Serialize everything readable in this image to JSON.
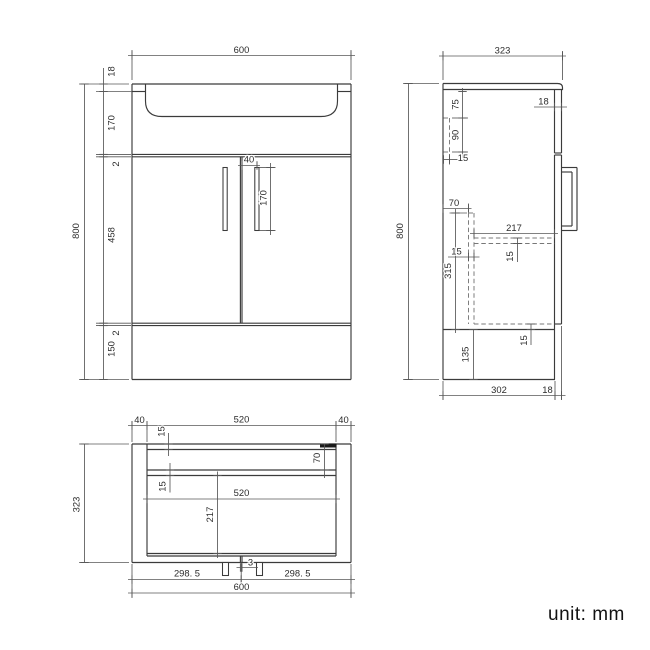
{
  "unit_note": "unit: mm",
  "colors": {
    "line": "#3b3b3b",
    "thin": "#575757",
    "dash": "#787878",
    "text": "#2b2b2b",
    "mark": "#1a1a1a"
  },
  "views": [
    {
      "name": "front-view",
      "lines": [
        [
          132,
          84,
          351,
          84
        ],
        [
          132,
          84,
          132,
          379.5
        ],
        [
          351,
          84,
          351,
          379.5
        ],
        [
          132,
          379.5,
          351,
          379.5
        ],
        [
          132,
          91.5,
          145.5,
          91.5
        ],
        [
          337.5,
          91.5,
          351,
          91.5
        ],
        [
          132,
          154.4,
          351,
          154.4
        ],
        [
          132,
          156.8,
          351,
          156.8
        ],
        [
          132,
          323.2,
          351,
          323.2
        ],
        [
          132,
          325.6,
          351,
          325.6
        ],
        [
          240.4,
          156.8,
          240.4,
          323.2
        ],
        [
          242,
          156.8,
          242,
          323.2
        ],
        [
          554.5,
          0,
          554.5,
          0
        ]
      ],
      "paths": [
        "M145.5,84 L145.5,101 Q145.5,116.5 162,116.5 L321,116.5 Q337.5,116.5 337.5,101 L337.5,84"
      ],
      "thin": [
        [
          132,
          80,
          132,
          50
        ],
        [
          351,
          80,
          351,
          50
        ],
        [
          129,
          84,
          79,
          84
        ],
        [
          129,
          379.5,
          79,
          379.5
        ],
        [
          96,
          91.5,
          132,
          91.5
        ],
        [
          96,
          154.4,
          131,
          154.4
        ],
        [
          96,
          156.8,
          131,
          156.8
        ],
        [
          96,
          323.2,
          131,
          323.2
        ],
        [
          96,
          325.6,
          131,
          325.6
        ],
        [
          257,
          170,
          257,
          161.5
        ],
        [
          259.5,
          167.5,
          275.5,
          167.5
        ],
        [
          259.5,
          230.5,
          275.5,
          230.5
        ]
      ],
      "dashed": [],
      "outline_rects": [
        [
          223,
          167.5,
          4.2,
          63
        ],
        [
          254.8,
          167.5,
          4.2,
          63
        ]
      ],
      "filled_rects": [],
      "dims": [
        {
          "o": "h",
          "p": 55.5,
          "a": 128,
          "b": 355,
          "t": [
            132,
            351
          ],
          "l": [
            {
              "s": "600",
              "x": 241.5,
              "y": 50.5,
              "r": 0
            }
          ]
        },
        {
          "o": "v",
          "p": 84.5,
          "a": 84,
          "b": 379.5,
          "t": [
            84,
            379.5
          ],
          "l": [
            {
              "s": "800",
              "x": 76.5,
              "y": 231,
              "r": -90
            }
          ]
        },
        {
          "o": "v",
          "p": 103.5,
          "a": 68,
          "b": 379.5,
          "t": [
            84,
            91.5,
            154.4,
            156.8,
            323.2,
            325.6,
            379.5
          ],
          "l": [
            {
              "s": "18",
              "x": 112,
              "y": 71.5,
              "r": -90
            },
            {
              "s": "170",
              "x": 112,
              "y": 123,
              "r": -90
            },
            {
              "s": "2",
              "x": 116.5,
              "y": 164,
              "r": -90
            },
            {
              "s": "458",
              "x": 112,
              "y": 235,
              "r": -90
            },
            {
              "s": "2",
              "x": 116.5,
              "y": 333,
              "r": -90
            },
            {
              "s": "150",
              "x": 112,
              "y": 349,
              "r": -90
            }
          ]
        },
        {
          "o": "h",
          "p": 165.5,
          "a": 238,
          "b": 260,
          "t": [
            242,
            257
          ],
          "l": [
            {
              "s": "40",
              "x": 249,
              "y": 160,
              "r": 0
            }
          ]
        },
        {
          "o": "v",
          "p": 270.5,
          "a": 163,
          "b": 235,
          "t": [
            167.5,
            230.5
          ],
          "l": [
            {
              "s": "170",
              "x": 264,
              "y": 198,
              "r": -90
            }
          ]
        }
      ]
    },
    {
      "name": "side-view",
      "lines": [
        [
          443,
          83.5,
          443,
          379.5
        ],
        [
          443,
          379.5,
          555,
          379.5
        ],
        [
          554.5,
          89.5,
          554.5,
          153
        ],
        [
          554.5,
          155,
          554.5,
          379.5
        ],
        [
          561.5,
          89.5,
          561.5,
          153
        ],
        [
          561.5,
          155,
          561.5,
          324
        ],
        [
          554.5,
          153,
          561.5,
          153
        ],
        [
          554.5,
          155,
          561.5,
          155
        ],
        [
          554.5,
          324,
          561.5,
          324
        ],
        [
          443,
          329.5,
          554.5,
          329.5
        ],
        [
          561.5,
          167.5,
          577,
          167.5
        ],
        [
          577,
          167.5,
          577,
          230.5
        ],
        [
          561.5,
          230.5,
          577,
          230.5
        ],
        [
          561.5,
          172,
          572,
          172
        ],
        [
          572,
          172,
          572,
          226
        ],
        [
          561.5,
          226,
          572,
          226
        ]
      ],
      "paths": [
        "M443,83.5 L557.5,83.5 Q562.5,83.5 562.5,87.5 L562.5,89.5 L443,89.5"
      ],
      "thin": [
        [
          443,
          80,
          443,
          51
        ],
        [
          562.5,
          80,
          562.5,
          51
        ],
        [
          439,
          83.5,
          403,
          83.5
        ],
        [
          439,
          379.5,
          403,
          379.5
        ],
        [
          452,
          118,
          468,
          118
        ],
        [
          452,
          152,
          468,
          152
        ],
        [
          449.5,
          154,
          449.5,
          164.5
        ],
        [
          468.5,
          211.5,
          468.5,
          203.5
        ],
        [
          449.5,
          213,
          467,
          213
        ],
        [
          474,
          236,
          474,
          228.5
        ],
        [
          443,
          381,
          443,
          400
        ],
        [
          555,
          381,
          555,
          400
        ],
        [
          561.5,
          326,
          561.5,
          400
        ]
      ],
      "dashed": [
        [
          449.5,
          118,
          449.5,
          152
        ],
        [
          443.5,
          118,
          449.5,
          118
        ],
        [
          443.5,
          152,
          449.5,
          152
        ],
        [
          468.5,
          213,
          468.5,
          324
        ],
        [
          474,
          213,
          474,
          324
        ],
        [
          468.5,
          213,
          474,
          213
        ],
        [
          474,
          238,
          554.5,
          238
        ],
        [
          474,
          243.5,
          554.5,
          243.5
        ],
        [
          474,
          324,
          554.5,
          324
        ]
      ],
      "outline_rects": [],
      "filled_rects": [],
      "dims": [
        {
          "o": "h",
          "p": 56,
          "a": 439,
          "b": 566,
          "t": [
            443,
            562.5
          ],
          "l": [
            {
              "s": "323",
              "x": 502.5,
              "y": 51,
              "r": 0
            }
          ]
        },
        {
          "o": "v",
          "p": 408.5,
          "a": 83.5,
          "b": 379.5,
          "t": [
            83.5,
            379.5
          ],
          "l": [
            {
              "s": "800",
              "x": 400.5,
              "y": 231,
              "r": -90
            }
          ]
        },
        {
          "o": "h",
          "p": 107,
          "a": 534,
          "b": 567,
          "t": [
            554.5,
            561.5
          ],
          "l": [
            {
              "s": "18",
              "x": 543.5,
              "y": 102,
              "r": 0
            }
          ]
        },
        {
          "o": "v",
          "p": 462.5,
          "a": 88,
          "b": 158,
          "t": [
            91.5,
            118,
            152
          ],
          "l": [
            {
              "s": "75",
              "x": 456,
              "y": 104.5,
              "r": -90
            },
            {
              "s": "90",
              "x": 456,
              "y": 135,
              "r": -90
            }
          ]
        },
        {
          "o": "h",
          "p": 159.5,
          "a": 443.5,
          "b": 459.5,
          "t": [
            443.5,
            449.5
          ],
          "l": [
            {
              "s": "15",
              "x": 463,
              "y": 158.5,
              "r": 0
            }
          ]
        },
        {
          "o": "h",
          "p": 208.5,
          "a": 443,
          "b": 471.5,
          "t": [
            443,
            468.5
          ],
          "l": [
            {
              "s": "70",
              "x": 454,
              "y": 203.5,
              "r": 0
            }
          ]
        },
        {
          "o": "v",
          "p": 455.5,
          "a": 209,
          "b": 333,
          "t": [
            213,
            329.5
          ],
          "l": [
            {
              "s": "315",
              "x": 448.5,
              "y": 271,
              "r": -90
            }
          ]
        },
        {
          "o": "h",
          "p": 257,
          "a": 448,
          "b": 479.5,
          "t": [
            468.5,
            474
          ],
          "l": [
            {
              "s": "15",
              "x": 456.5,
              "y": 252,
              "r": 0
            }
          ]
        },
        {
          "o": "h",
          "p": 233.5,
          "a": 470,
          "b": 558,
          "t": [
            474,
            554.5
          ],
          "l": [
            {
              "s": "217",
              "x": 514,
              "y": 228.5,
              "r": 0
            }
          ]
        },
        {
          "o": "v",
          "p": 517.5,
          "a": 238,
          "b": 262,
          "t": [
            238,
            243.5
          ],
          "l": [
            {
              "s": "15",
              "x": 510.5,
              "y": 256.5,
              "r": -90
            }
          ]
        },
        {
          "o": "v",
          "p": 531,
          "a": 324,
          "b": 345,
          "t": [
            324,
            329.5
          ],
          "l": [
            {
              "s": "15",
              "x": 524.5,
              "y": 340.5,
              "r": -90
            }
          ]
        },
        {
          "o": "v",
          "p": 473.5,
          "a": 329.5,
          "b": 379.5,
          "t": [
            329.5,
            379.5
          ],
          "l": [
            {
              "s": "135",
              "x": 466,
              "y": 354.5,
              "r": -90
            }
          ]
        },
        {
          "o": "h",
          "p": 395.5,
          "a": 439,
          "b": 565.5,
          "t": [
            443,
            555,
            561.5
          ],
          "l": [
            {
              "s": "302",
              "x": 499,
              "y": 390.5,
              "r": 0
            },
            {
              "s": "18",
              "x": 547.5,
              "y": 390.5,
              "r": 0
            }
          ]
        }
      ]
    },
    {
      "name": "plan-view",
      "lines": [
        [
          132,
          444,
          351,
          444
        ],
        [
          132,
          444,
          132,
          562.5
        ],
        [
          351,
          444,
          351,
          562.5
        ],
        [
          132,
          562.5,
          351,
          562.5
        ],
        [
          147,
          444,
          147,
          556
        ],
        [
          336,
          444,
          336,
          556
        ],
        [
          147,
          449.5,
          336,
          449.5
        ],
        [
          147,
          470,
          336,
          470
        ],
        [
          147,
          475.5,
          336,
          475.5
        ],
        [
          147,
          553.5,
          336,
          553.5
        ],
        [
          147,
          556,
          336,
          556
        ],
        [
          240.4,
          556,
          240.4,
          562.5
        ],
        [
          242,
          556,
          242,
          562.5
        ]
      ],
      "paths": [],
      "thin": [
        [
          132,
          442,
          132,
          421
        ],
        [
          147,
          442,
          147,
          421
        ],
        [
          336,
          442,
          336,
          421
        ],
        [
          351,
          442,
          351,
          421
        ],
        [
          129,
          444,
          79,
          444
        ],
        [
          129,
          562.5,
          79,
          562.5
        ],
        [
          132,
          564,
          132,
          598
        ],
        [
          351,
          564,
          351,
          598
        ],
        [
          241.2,
          562.5,
          241.2,
          584
        ]
      ],
      "dashed": [],
      "outline_rects": [
        [
          222.5,
          562.5,
          6,
          13
        ],
        [
          256.5,
          562.5,
          6,
          13
        ]
      ],
      "filled_rects": [
        [
          320,
          443.5,
          16.5,
          4
        ]
      ],
      "dims": [
        {
          "o": "h",
          "p": 425.5,
          "a": 128,
          "b": 355,
          "t": [
            132,
            147,
            336,
            351
          ],
          "l": [
            {
              "s": "40",
              "x": 139.5,
              "y": 420.5,
              "r": 0
            },
            {
              "s": "520",
              "x": 241.5,
              "y": 420,
              "r": 0
            },
            {
              "s": "40",
              "x": 343.5,
              "y": 420.5,
              "r": 0
            }
          ]
        },
        {
          "o": "v",
          "p": 168.5,
          "a": 433,
          "b": 456,
          "t": [
            444,
            449.5
          ],
          "l": [
            {
              "s": "15",
              "x": 162,
              "y": 431.5,
              "r": -90
            }
          ]
        },
        {
          "o": "v",
          "p": 324.5,
          "a": 444,
          "b": 478,
          "t": [
            444,
            470
          ],
          "l": [
            {
              "s": "70",
              "x": 317.5,
              "y": 458,
              "r": -90
            }
          ]
        },
        {
          "o": "v",
          "p": 170,
          "a": 463,
          "b": 492.5,
          "t": [
            470,
            475.5
          ],
          "l": [
            {
              "s": "15",
              "x": 163,
              "y": 486.5,
              "r": -90
            }
          ]
        },
        {
          "o": "h",
          "p": 499,
          "a": 143,
          "b": 340,
          "t": [
            147,
            336
          ],
          "l": [
            {
              "s": "520",
              "x": 241.5,
              "y": 493.5,
              "r": 0
            }
          ]
        },
        {
          "o": "v",
          "p": 217.5,
          "a": 471.5,
          "b": 558,
          "t": [
            475.5,
            553.5
          ],
          "l": [
            {
              "s": "217",
              "x": 210.5,
              "y": 514.5,
              "r": -90
            }
          ]
        },
        {
          "o": "h",
          "p": 567.5,
          "a": 236.5,
          "b": 258,
          "t": [
            240.4,
            242
          ],
          "l": [
            {
              "s": "3",
              "x": 250.5,
              "y": 563,
              "r": 0
            }
          ]
        },
        {
          "o": "h",
          "p": 579.5,
          "a": 128,
          "b": 355,
          "t": [
            132,
            241.2,
            351
          ],
          "l": [
            {
              "s": "298. 5",
              "x": 187,
              "y": 574,
              "r": 0
            },
            {
              "s": "298. 5",
              "x": 297.5,
              "y": 574,
              "r": 0
            }
          ]
        },
        {
          "o": "h",
          "p": 593,
          "a": 128,
          "b": 355,
          "t": [
            132,
            351
          ],
          "l": [
            {
              "s": "600",
              "x": 241.5,
              "y": 587.5,
              "r": 0
            }
          ]
        },
        {
          "o": "v",
          "p": 84.5,
          "a": 444,
          "b": 562.5,
          "t": [
            444,
            562.5
          ],
          "l": [
            {
              "s": "323",
              "x": 77,
              "y": 504.5,
              "r": -90
            }
          ]
        }
      ]
    }
  ]
}
